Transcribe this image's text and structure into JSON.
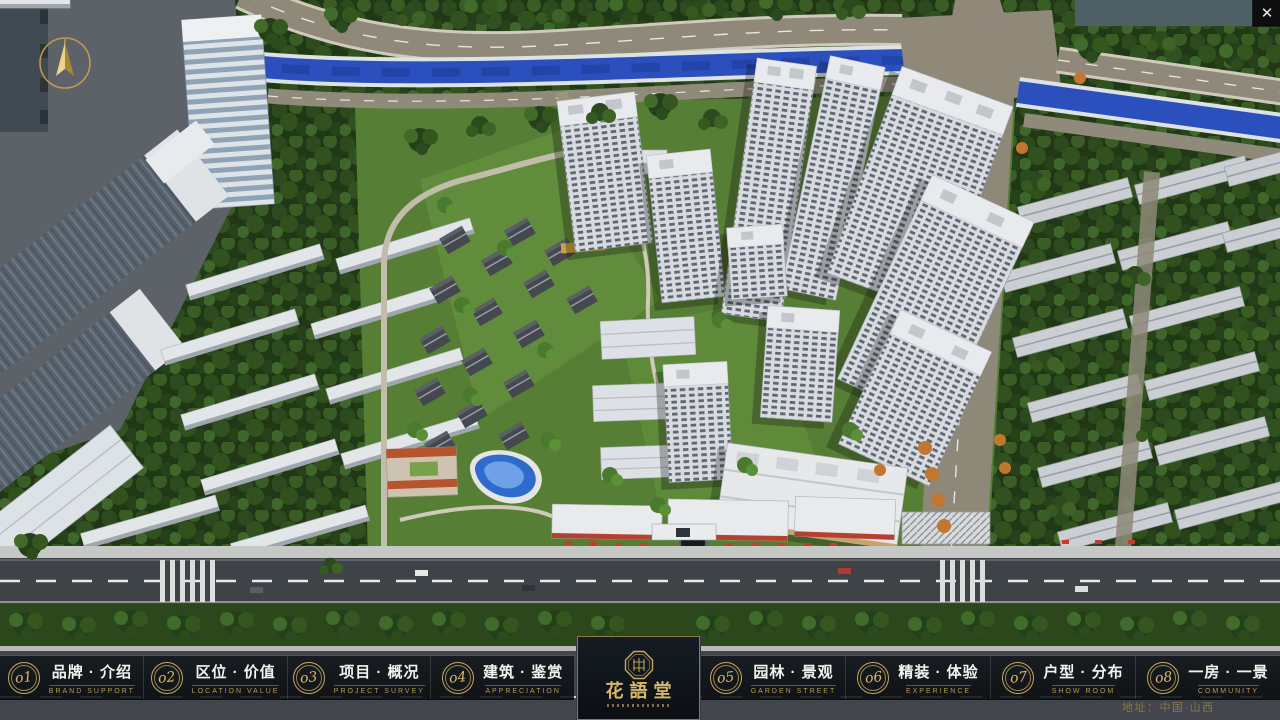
{
  "window": {
    "close_icon": "✕"
  },
  "nav": {
    "left_items": [
      {
        "num": "o1",
        "label": "品牌 · 介绍",
        "sub": "BRAND SUPPORT"
      },
      {
        "num": "o2",
        "label": "区位 · 价值",
        "sub": "LOCATION VALUE"
      },
      {
        "num": "o3",
        "label": "项目 · 概况",
        "sub": "PROJECT SURVEY"
      },
      {
        "num": "o4",
        "label": "建筑 · 鉴赏",
        "sub": "APPRECIATION"
      }
    ],
    "right_items": [
      {
        "num": "o5",
        "label": "园林 · 景观",
        "sub": "GARDEN STREET"
      },
      {
        "num": "o6",
        "label": "精装 · 体验",
        "sub": "EXPERIENCE"
      },
      {
        "num": "o7",
        "label": "户型 · 分布",
        "sub": "SHOW ROOM"
      },
      {
        "num": "o8",
        "label": "一房 · 一景",
        "sub": "COMMUNITY"
      }
    ]
  },
  "logo": {
    "title": "花語堂"
  },
  "footer": {
    "address": "地址：中国·山西"
  },
  "colors": {
    "brand_gold": "#c9a85c",
    "nav_background": "rgba(10,14,18,0.84)",
    "address_text": "#867a46",
    "river_blue": "#2b50bd",
    "accent_red": "#b5402f"
  }
}
